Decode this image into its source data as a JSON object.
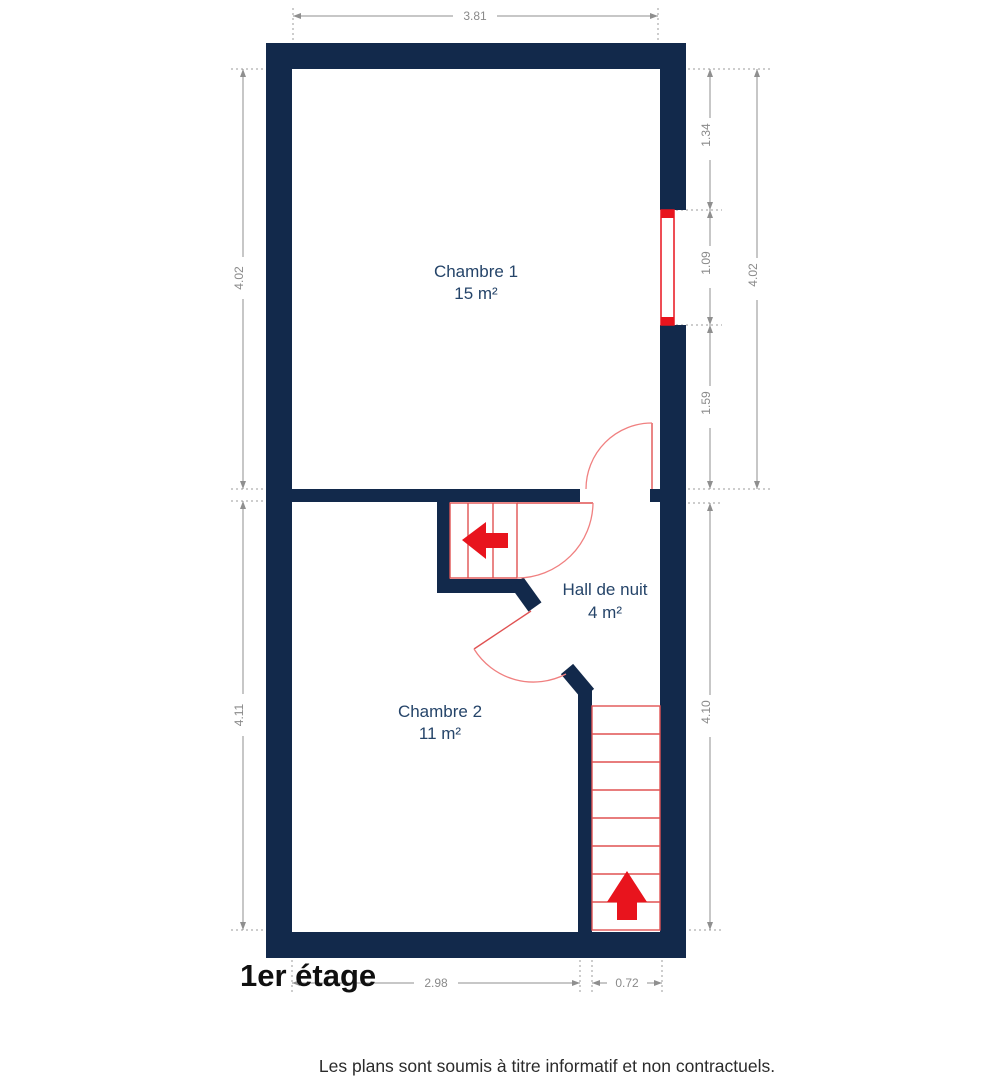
{
  "plan": {
    "title": "1er étage",
    "disclaimer": "Les plans sont soumis à titre informatif et non contractuels.",
    "rooms": [
      {
        "name": "Chambre 1",
        "area": "15 m²"
      },
      {
        "name": "Chambre 2",
        "area": "11 m²"
      },
      {
        "name": "Hall de nuit",
        "area": "4 m²"
      }
    ],
    "dimensions": {
      "top_width": "3.81",
      "left_upper": "4.02",
      "left_lower": "4.11",
      "right_seg1": "1.34",
      "right_seg2": "1.09",
      "right_seg3": "1.59",
      "right_total": "4.02",
      "right_lower": "4.10",
      "bottom_left": "2.98",
      "bottom_right": "0.72"
    },
    "colors": {
      "wall": "#12294B",
      "accent_red": "#E8141D",
      "stair_red": "#E05252",
      "arc_red": "#F08080",
      "dim_gray": "#8F8F8F",
      "label_blue": "#254469"
    }
  }
}
